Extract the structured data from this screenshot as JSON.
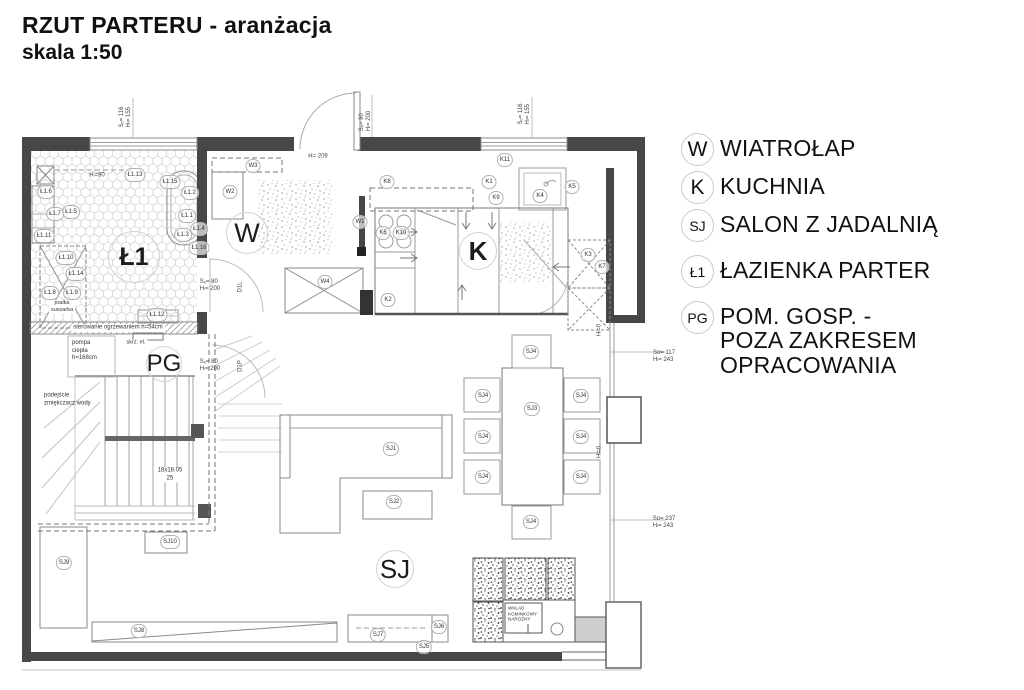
{
  "title": {
    "line1": "RZUT PARTERU - aranżacja",
    "line2": "skala 1:50"
  },
  "legend": {
    "items": [
      {
        "symbol": "W",
        "label": "WIATROŁAP"
      },
      {
        "symbol": "K",
        "label": "KUCHNIA"
      },
      {
        "symbol": "SJ",
        "label": "SALON Z JADALNIĄ"
      },
      {
        "symbol": "Ł1",
        "label": "ŁAZIENKA PARTER"
      },
      {
        "symbol": "PG",
        "label": "POM. GOSP. -\nPOZA ZAKRESEM\nOPRACOWANIA"
      }
    ]
  },
  "plan": {
    "room_labels": [
      {
        "text": "Ł1",
        "x": 134,
        "y": 257,
        "fs": 25,
        "r": 25,
        "bold": true
      },
      {
        "text": "W",
        "x": 247,
        "y": 233,
        "fs": 27,
        "r": 20
      },
      {
        "text": "K",
        "x": 478,
        "y": 251,
        "fs": 26,
        "r": 18,
        "bold": true
      },
      {
        "text": "PG",
        "x": 164,
        "y": 364,
        "fs": 24,
        "r": 17
      },
      {
        "text": "SJ",
        "x": 395,
        "y": 569,
        "fs": 26,
        "r": 18
      }
    ],
    "tags": [
      {
        "text": "Ł1.13",
        "x": 135,
        "y": 175
      },
      {
        "text": "Ł1.15",
        "x": 170,
        "y": 182
      },
      {
        "text": "Ł1.2",
        "x": 190,
        "y": 193
      },
      {
        "text": "Ł1.6",
        "x": 46,
        "y": 192
      },
      {
        "text": "Ł1.5",
        "x": 71,
        "y": 212
      },
      {
        "text": "Ł1.7",
        "x": 55,
        "y": 214
      },
      {
        "text": "Ł1.1",
        "x": 187,
        "y": 216
      },
      {
        "text": "Ł1.11",
        "x": 44,
        "y": 236
      },
      {
        "text": "Ł1.3",
        "x": 183,
        "y": 235
      },
      {
        "text": "Ł1.4",
        "x": 199,
        "y": 229
      },
      {
        "text": "Ł1.16",
        "x": 199,
        "y": 248
      },
      {
        "text": "Ł1.10",
        "x": 66,
        "y": 258
      },
      {
        "text": "Ł1.14",
        "x": 76,
        "y": 274
      },
      {
        "text": "Ł1.8",
        "x": 50,
        "y": 293
      },
      {
        "text": "Ł1.9",
        "x": 72,
        "y": 293
      },
      {
        "text": "Ł1.12",
        "x": 157,
        "y": 315
      },
      {
        "text": "W3",
        "x": 253,
        "y": 166
      },
      {
        "text": "W2",
        "x": 230,
        "y": 192
      },
      {
        "text": "W1",
        "x": 360,
        "y": 222
      },
      {
        "text": "W4",
        "x": 325,
        "y": 282
      },
      {
        "text": "K11",
        "x": 505,
        "y": 160
      },
      {
        "text": "K8",
        "x": 387,
        "y": 182
      },
      {
        "text": "K1",
        "x": 489,
        "y": 182
      },
      {
        "text": "K9",
        "x": 496,
        "y": 198
      },
      {
        "text": "K4",
        "x": 540,
        "y": 196
      },
      {
        "text": "K5",
        "x": 572,
        "y": 187
      },
      {
        "text": "K6",
        "x": 383,
        "y": 233
      },
      {
        "text": "K10",
        "x": 401,
        "y": 233
      },
      {
        "text": "K2",
        "x": 388,
        "y": 300
      },
      {
        "text": "K3",
        "x": 588,
        "y": 255
      },
      {
        "text": "K7",
        "x": 602,
        "y": 267
      },
      {
        "text": "SJ4",
        "x": 531,
        "y": 352
      },
      {
        "text": "SJ4",
        "x": 483,
        "y": 396
      },
      {
        "text": "SJ4",
        "x": 483,
        "y": 437
      },
      {
        "text": "SJ4",
        "x": 483,
        "y": 477
      },
      {
        "text": "SJ3",
        "x": 532,
        "y": 409
      },
      {
        "text": "SJ4",
        "x": 581,
        "y": 396
      },
      {
        "text": "SJ4",
        "x": 581,
        "y": 437
      },
      {
        "text": "SJ4",
        "x": 581,
        "y": 477
      },
      {
        "text": "SJ4",
        "x": 531,
        "y": 522
      },
      {
        "text": "SJ1",
        "x": 391,
        "y": 449
      },
      {
        "text": "SJ2",
        "x": 394,
        "y": 502
      },
      {
        "text": "SJ10",
        "x": 170,
        "y": 542
      },
      {
        "text": "SJ9",
        "x": 64,
        "y": 563
      },
      {
        "text": "SJ8",
        "x": 139,
        "y": 631
      },
      {
        "text": "SJ7",
        "x": 378,
        "y": 635
      },
      {
        "text": "SJ6",
        "x": 439,
        "y": 627
      },
      {
        "text": "SJ5",
        "x": 424,
        "y": 647
      }
    ],
    "dims": [
      {
        "text": "Sₒ= 116\nHₗ= 155",
        "x": 126,
        "y": 117,
        "v": true
      },
      {
        "text": "Sₒ= 90\nHₗ= 200",
        "x": 366,
        "y": 121,
        "v": true
      },
      {
        "text": "Sₒ= 116\nHₗ= 155",
        "x": 525,
        "y": 114,
        "v": true
      },
      {
        "text": "H= 209",
        "x": 318,
        "y": 157
      },
      {
        "text": "Hₗ=90",
        "x": 97,
        "y": 176
      },
      {
        "text": "Sₒ= 80\nHₗ= 200",
        "x": 210,
        "y": 286
      },
      {
        "text": "D1L",
        "x": 241,
        "y": 287,
        "v": true
      },
      {
        "text": "Sₒ= 80\nHₗ= 200",
        "x": 210,
        "y": 366
      },
      {
        "text": "D1P",
        "x": 241,
        "y": 366,
        "v": true
      },
      {
        "text": "So= 117\nHₗ= 243",
        "x": 664,
        "y": 357
      },
      {
        "text": "So= 237\nHₗ= 243",
        "x": 664,
        "y": 523
      },
      {
        "text": "Hₗ=0",
        "x": 600,
        "y": 330,
        "v": true
      },
      {
        "text": "Hₗ=0",
        "x": 600,
        "y": 452,
        "v": true
      }
    ],
    "notes": [
      {
        "text": "sterowanie ogrzewaniem h=54cm",
        "x": 118,
        "y": 328,
        "bg": true
      },
      {
        "text": "pompa\nciepła\nh=168cm",
        "x": 72,
        "y": 351,
        "left": true
      },
      {
        "text": "skrz. el.",
        "x": 136,
        "y": 343,
        "bg": true,
        "fs": 5.5
      },
      {
        "text": "podejście\nzmiękczacz wody",
        "x": 44,
        "y": 400,
        "left": true
      },
      {
        "text": "18x18.05\n25",
        "x": 170,
        "y": 475,
        "bg": true
      },
      {
        "text": "pralka\nsuszarka",
        "x": 62,
        "y": 307,
        "bg": true,
        "fs": 5.5
      },
      {
        "text": "WKŁAD\nKOMINKOWY\nNAROŻNY",
        "x": 508,
        "y": 614,
        "left": true,
        "fs": 4.6
      }
    ]
  }
}
